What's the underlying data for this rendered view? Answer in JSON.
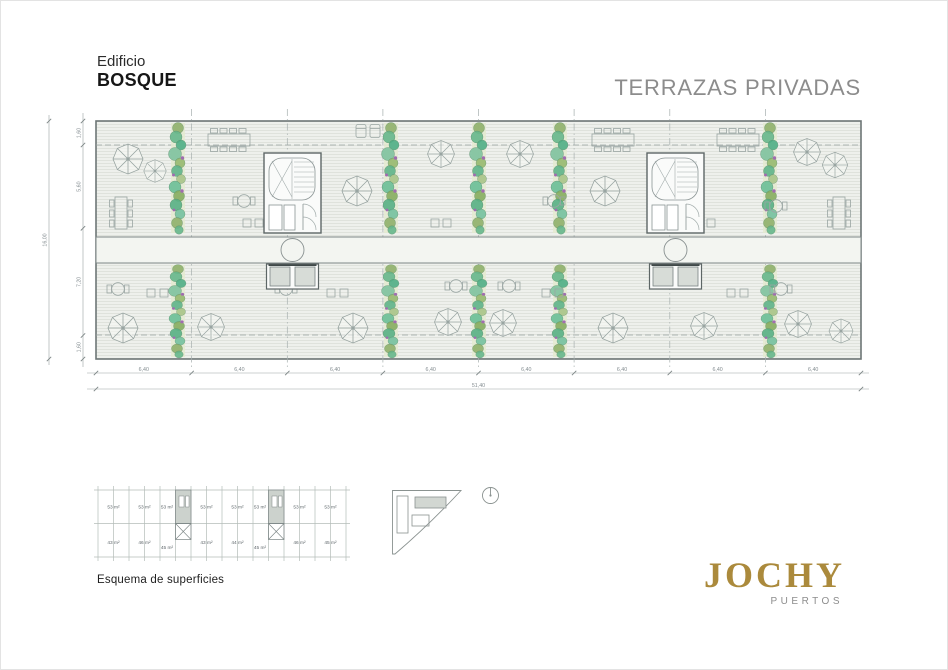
{
  "header": {
    "building_label": "Edificio",
    "building_name": "BOSQUE",
    "sheet_title": "TERRAZAS PRIVADAS"
  },
  "plan": {
    "dim_total_width": "51,40",
    "dim_bays": [
      "6,40",
      "6,40",
      "6,40",
      "6,40",
      "6,40",
      "6,40",
      "6,40",
      "6,40"
    ],
    "dim_total_height": "16,00",
    "dim_height_segments": [
      "1,60",
      "5,60",
      "7,20",
      "1,60"
    ]
  },
  "schema": {
    "caption": "Esquema de superficies",
    "top_row": [
      "53 m²",
      "53 m²",
      "53 m²",
      "53 m²",
      "53 m²",
      "53 m²",
      "53 m²",
      "53 m²"
    ],
    "bottom_row": [
      "43 m²",
      "46 m²",
      "45 m²",
      "43 m²",
      "44 m²",
      "45 m²",
      "46 m²",
      "45 m²"
    ]
  },
  "logo": {
    "name": "JOCHY",
    "subtitle": "PUERTOS",
    "color": "#ab8a3c"
  },
  "colors": {
    "sheet_title_gray": "#8c8c8c",
    "plan_line": "#6d7676",
    "plant_green": "#6fbb92",
    "hatch_fill": "#eef0ec"
  }
}
